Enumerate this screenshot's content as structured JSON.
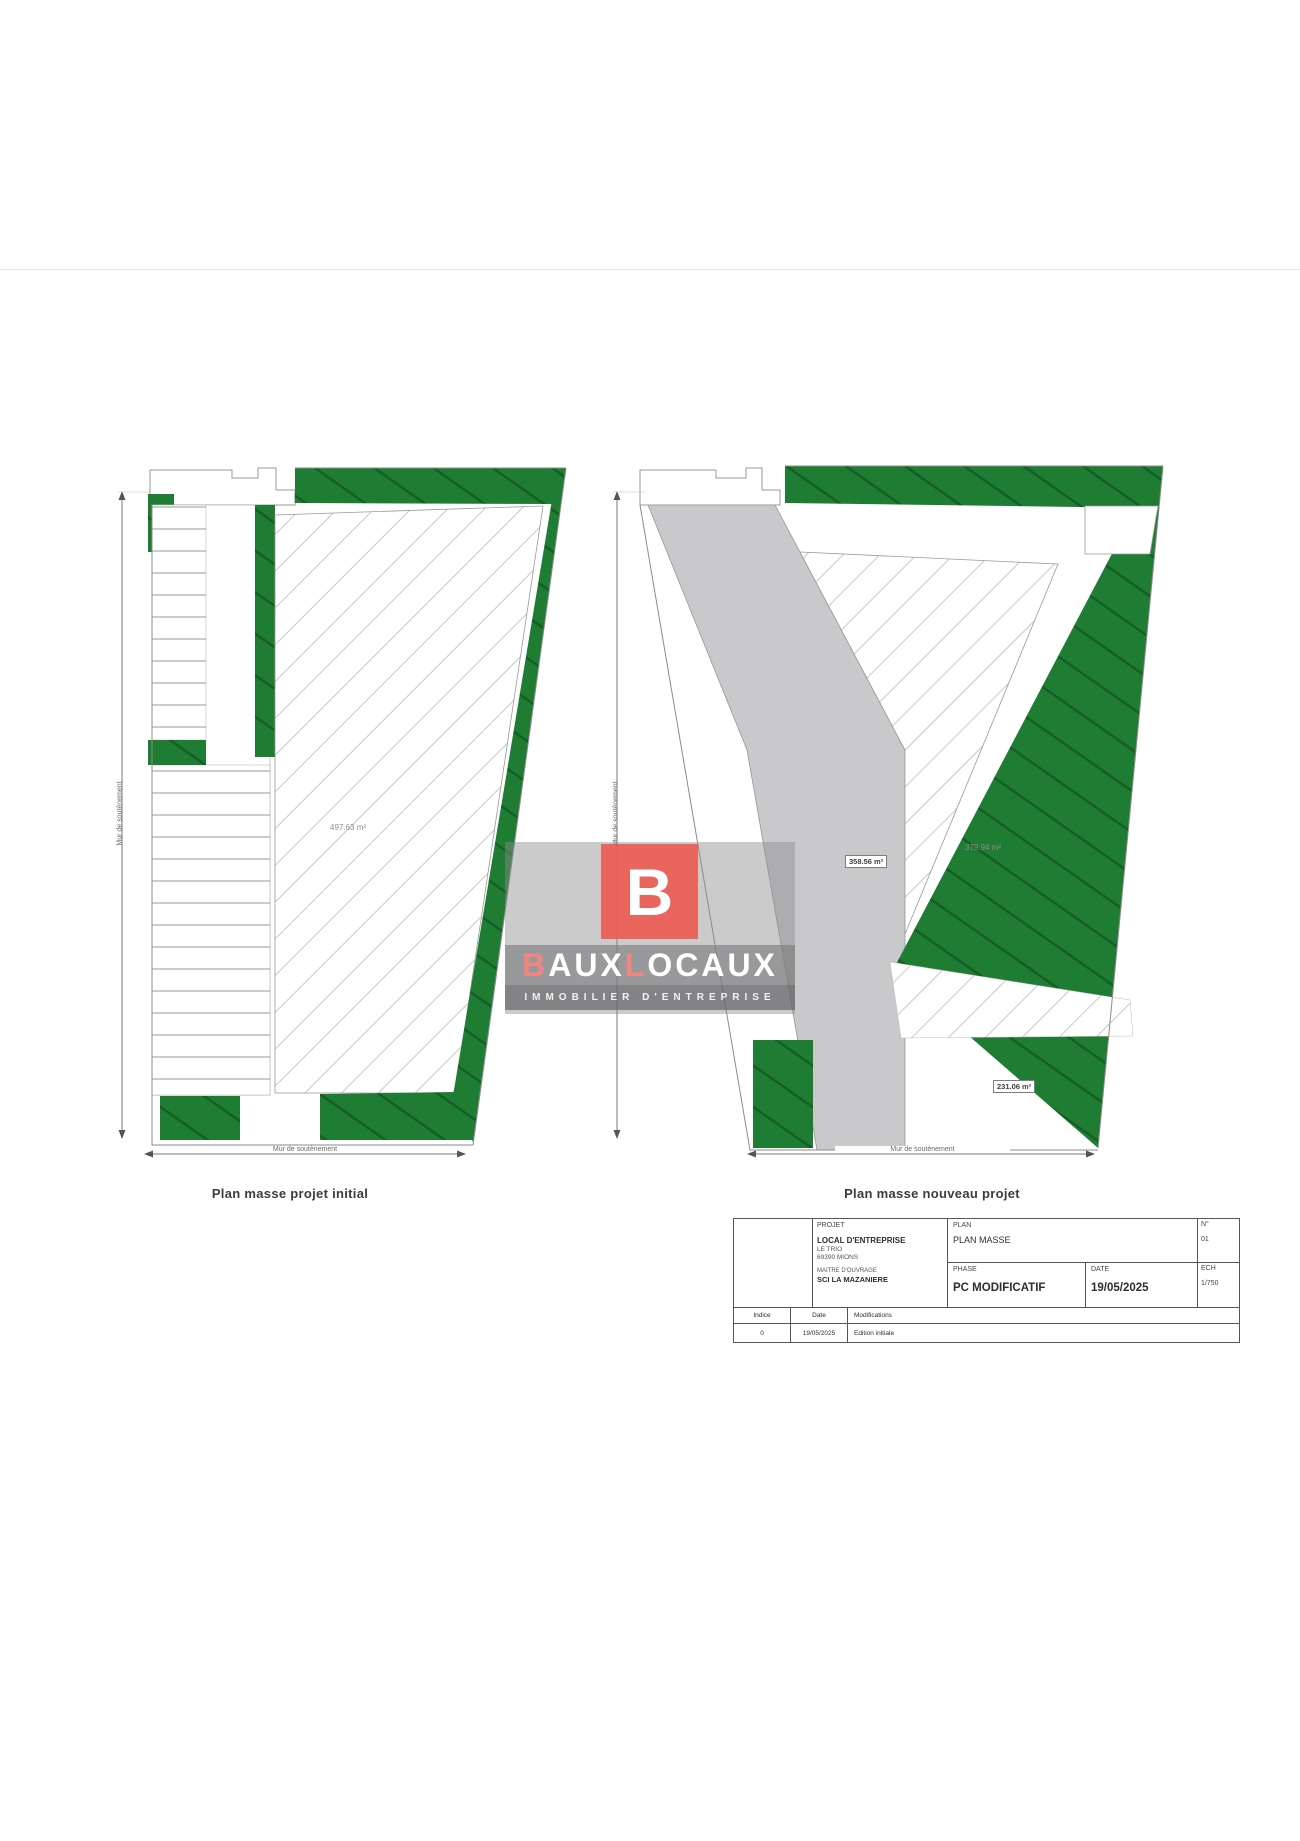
{
  "watermark": {
    "logo_letter": "B",
    "brand_part1": "B",
    "brand_part2": "AUX",
    "brand_part3": "L",
    "brand_part4": "OCAUX",
    "tagline": "IMMOBILIER D'ENTREPRISE",
    "accent_color": "#ec5c54"
  },
  "plans": {
    "initial": {
      "caption": "Plan masse projet initial",
      "area_hatch": "497.63 m²",
      "dim_left": "Mur de soutènement",
      "dim_bottom": "Mur de soutènement"
    },
    "nouveau": {
      "caption": "Plan masse nouveau projet",
      "area_gray": "358.56 m²",
      "area_hatch": "379.94 m²",
      "area_green": "231.06 m²",
      "dim_left": "Mur de soutènement",
      "dim_bottom": "Mur de soutènement"
    },
    "green_color": "#1f7c33",
    "gray_color": "#c9c9cb"
  },
  "titleblock": {
    "projet_header": "PROJET",
    "projet_name": "LOCAL D'ENTREPRISE",
    "projet_line2": "LE TRIO",
    "projet_line3": "69390 MIONS",
    "maitre_header": "MAITRE D'OUVRAGE",
    "maitre_name": "SCI LA MAZANIERE",
    "plan_header": "PLAN",
    "plan_value": "PLAN MASSE",
    "phase_header": "PHASE",
    "phase_value": "PC MODIFICATIF",
    "date_header": "DATE",
    "date_value": "19/05/2025",
    "num_header": "N°",
    "num_value": "01",
    "ech_header": "ECH",
    "ech_value": "1/750",
    "rev_col_indice": "Indice",
    "rev_col_date": "Date",
    "rev_col_modif": "Modifications",
    "rev_indice": "0",
    "rev_date": "19/05/2025",
    "rev_modif": "Edition initiale"
  }
}
